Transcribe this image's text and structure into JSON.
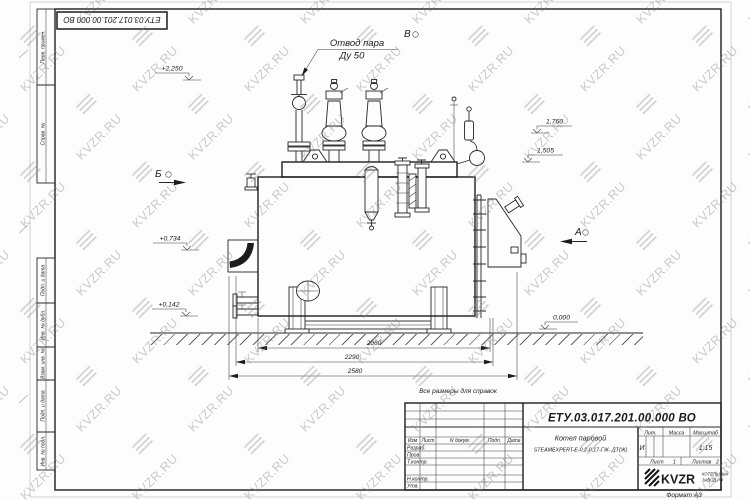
{
  "sheet": {
    "doc_number": "ЕТУ.03.017.201.00.000  ВО",
    "format": "Формат А3"
  },
  "frame_labels": {
    "perv_primen": "Перв. примен.",
    "sprav_no": "Справ. №",
    "podp_i_data": "Подп. и дата",
    "inv_dubl": "Инв. № дубл.",
    "vzam_inv": "Взам. инв. №",
    "inv_podl": "Инв. № подл."
  },
  "annotations": {
    "steam_outlet_1": "Отвод пара",
    "steam_outlet_2": "Ду 50",
    "note": "Все размеры для справок",
    "view_a": "А",
    "view_b": "Б",
    "view_v": "В"
  },
  "elevations": [
    "+2,250",
    "1,760",
    "1,505",
    "+0,734",
    "+0,142",
    "0,000"
  ],
  "dimensions": [
    "2060",
    "2290",
    "2580"
  ],
  "title_block": {
    "doc_number": "ЕТУ.03.017.201.00.000  ВО",
    "col_izm": "Изм",
    "col_list": "Лист",
    "col_ndoc": "N докум.",
    "col_podp": "Подп.",
    "col_data": "Дата",
    "row_razrab": "Разраб.",
    "row_prov": "Пров.",
    "row_tkontr": "Т.контр.",
    "row_nkontr": "Н.контр.",
    "row_utv": "Утв.",
    "name_line1": "Котел паровой",
    "name_line2": "STEAMEXPERT-E-0,2-0,17-ГЖ- ДТ(Ж)",
    "lit_label": "Лит.",
    "massa_label": "Масса",
    "masshtab_label": "Масштаб",
    "lit_value": "И",
    "scale_value": "1:15",
    "list_label": "Лист",
    "list_value": "1",
    "listov_label": "Листов",
    "listov_value": "2",
    "logo_text": "KVZR",
    "logo_sub1": "КОТЕЛЬНЫЙ",
    "logo_sub2": "ЗАВОД.РФ"
  },
  "watermark": {
    "text": "KVZR.RU"
  }
}
